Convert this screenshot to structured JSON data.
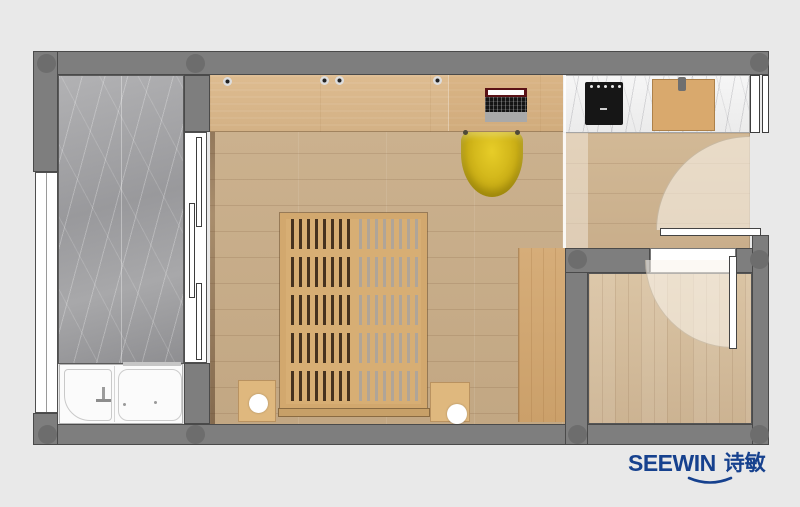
{
  "logo": {
    "text_en": "SEEWIN",
    "text_cjk": "诗敏",
    "color": "#16418e"
  },
  "palette": {
    "canvas_bg": "#e9e9e9",
    "wall": "#7e7e7e",
    "wall_outline": "#4a4a4a",
    "column_marker": "#6d6d6d",
    "bedroom_wood_floor": "#c8ae8b",
    "hallway_wood_floor": "#cfb593",
    "bathroom_wood_floor": "#d7c1a1",
    "desk_wood": "#dcba8e",
    "wardrobe_wood": "#d4ab77",
    "balcony_marble": "#a3a3a6",
    "counter_marble": "#f3f3f3",
    "chair_yellow": "#d3b71b",
    "bed_slat_wood": "#d7ae74",
    "bed_gap_dark": "#46321f",
    "door_white": "#ffffff",
    "cooktop_black": "#161616"
  },
  "elements": [
    "floor-plan",
    "top-wall",
    "bottom-wall",
    "left-wall",
    "right-wall",
    "balcony-marble-floor",
    "left-window",
    "balcony-sliding-window",
    "walk-in-tub",
    "soaking-tub",
    "faucet-icon",
    "bedroom-floor",
    "desk",
    "laptop",
    "cabinet-knob",
    "desk-chair",
    "slatted-platform-bed",
    "bed-rail",
    "nightstand",
    "bedside-lamp",
    "wardrobe-cabinet",
    "kitchen-counter",
    "cooktop",
    "cutting-board",
    "hallway-floor",
    "entry-door",
    "door-swing-arc",
    "bathroom-floor",
    "bathroom-door",
    "column-marker",
    "brand-logo"
  ]
}
